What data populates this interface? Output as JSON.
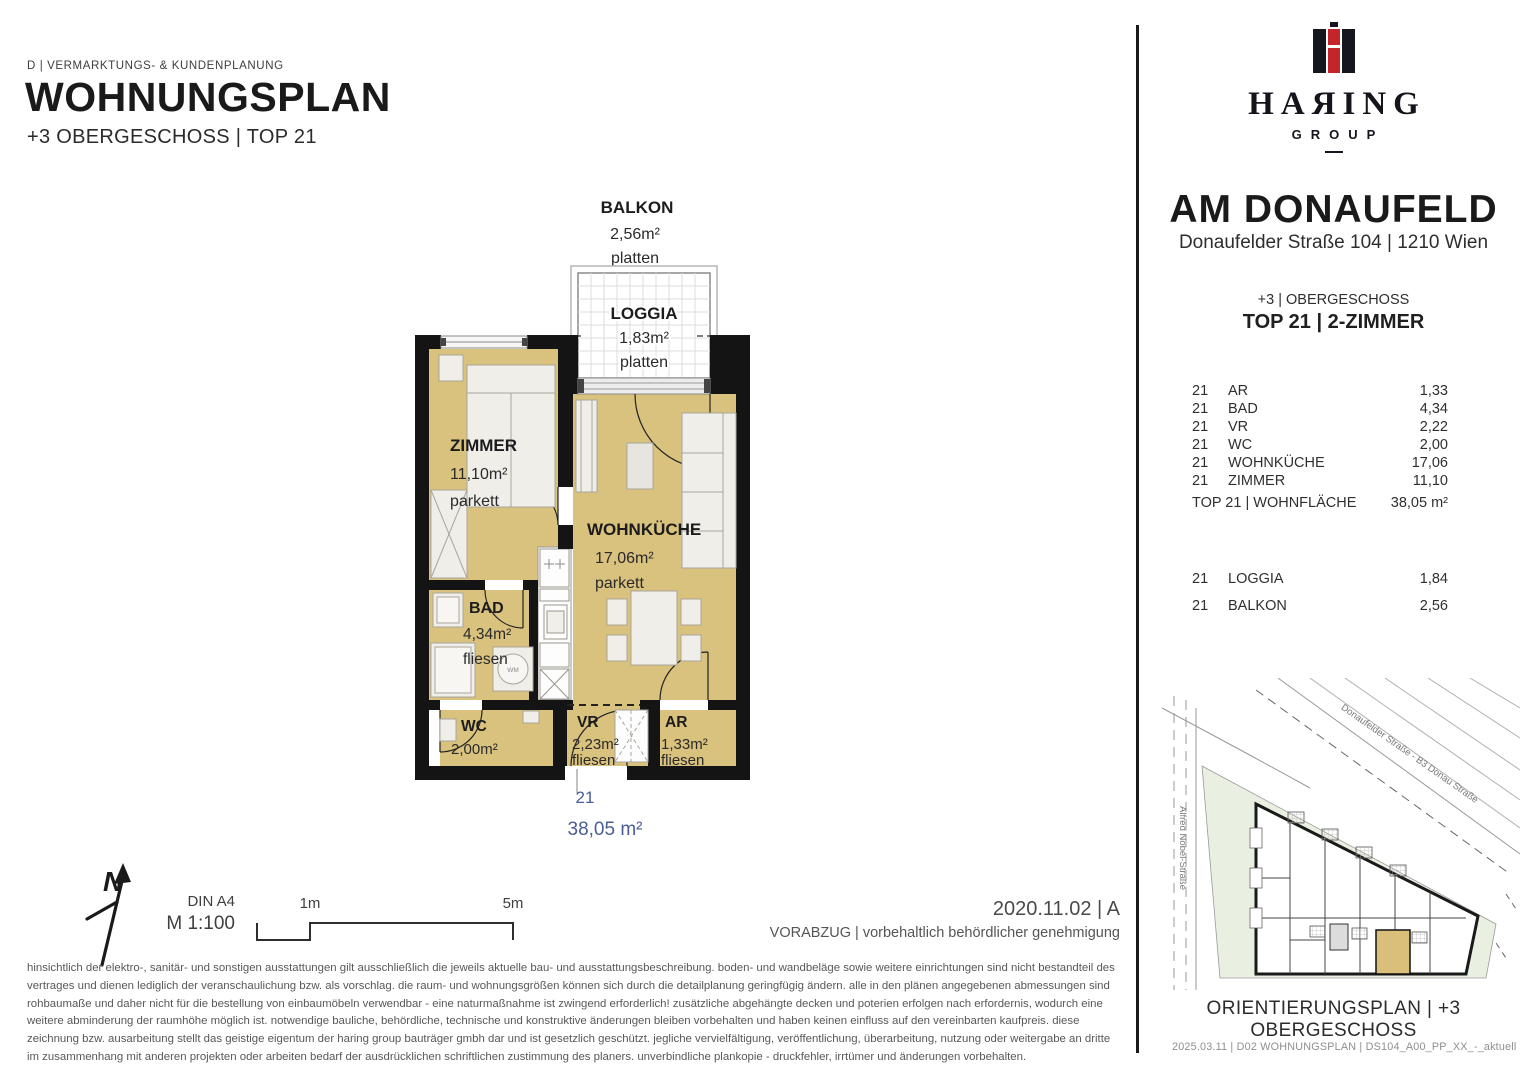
{
  "header": {
    "dept_line": "D | VERMARKTUNGS- & KUNDENPLANUNG",
    "title": "WOHNUNGSPLAN",
    "subtitle": "+3 OBERGESCHOSS | TOP 21"
  },
  "floorplan": {
    "balkon": {
      "name": "BALKON",
      "area": "2,56m²",
      "floor": "platten"
    },
    "loggia": {
      "name": "LOGGIA",
      "area": "1,83m²",
      "floor": "platten"
    },
    "zimmer": {
      "name": "ZIMMER",
      "area": "11,10m²",
      "floor": "parkett"
    },
    "wohnkueche": {
      "name": "WOHNKÜCHE",
      "area": "17,06m²",
      "floor": "parkett"
    },
    "bad": {
      "name": "BAD",
      "area": "4,34m²",
      "floor": "fliesen"
    },
    "wc": {
      "name": "WC",
      "area": "2,00m²"
    },
    "vr": {
      "name": "VR",
      "area": "2,23m²",
      "floor": "fliesen"
    },
    "ar": {
      "name": "AR",
      "area": "1,33m²",
      "floor": "fliesen"
    },
    "wm_label": "WM",
    "unit_number": "21",
    "unit_area": "38,05 m²",
    "accent_blue": "#4a5d94",
    "room_fill": "#d9c17e",
    "wall_color": "#141414"
  },
  "scalebar": {
    "din": "DIN A4",
    "scale": "M 1:100",
    "m1": "1m",
    "m5": "5m",
    "north": "N"
  },
  "version": {
    "date_line": "2020.11.02 | A",
    "status_line": "VORABZUG | vorbehaltlich behördlicher genehmigung"
  },
  "disclaimer": "hinsichtlich der elektro-, sanitär- und sonstigen ausstattungen gilt ausschließlich die jeweils aktuelle bau- und ausstattungsbeschreibung. boden- und wandbeläge sowie weitere einrichtungen sind nicht bestandteil des vertrages und dienen lediglich der veranschaulichung bzw. als vorschlag. die raum- und wohnungsgrößen können sich durch die detailplanung geringfügig ändern. alle in den plänen angegebenen abmessungen sind rohbaumaße und daher nicht für die bestellung von einbaumöbeln verwendbar - eine naturmaßnahme ist zwingend erforderlich! zusätzliche abgehängte decken und poterien erfolgen nach erfordernis, wodurch eine weitere abminderung der raumhöhe möglich ist. notwendige bauliche, behördliche, technische und konstruktive änderungen bleiben vorbehalten und haben keinen einfluss auf den vereinbarten kaufpreis. diese zeichnung bzw. ausarbeitung stellt das geistige eigentum der haring group bauträger gmbh dar und ist gesetzlich geschützt. jegliche vervielfältigung, veröffentlichung, überarbeitung, nutzung oder weitergabe an dritte im zusammenhang mit anderen projekten oder arbeiten bedarf der ausdrücklichen schriftlichen zustimmung des planers. unverbindliche plankopie - druckfehler, irrtümer und änderungen vorbehalten.",
  "brand": {
    "name": "HAЯING",
    "group": "GROUP",
    "red": "#c5242b"
  },
  "project": {
    "title": "AM DONAUFELD",
    "address": "Donaufelder Straße 104 | 1210 Wien",
    "floor_line": "+3 | OBERGESCHOSS",
    "top_line": "TOP 21 | 2-ZIMMER"
  },
  "room_table": {
    "rows": [
      {
        "nr": "21",
        "name": "AR",
        "value": "1,33"
      },
      {
        "nr": "21",
        "name": "BAD",
        "value": "4,34"
      },
      {
        "nr": "21",
        "name": "VR",
        "value": "2,22"
      },
      {
        "nr": "21",
        "name": "WC",
        "value": "2,00"
      },
      {
        "nr": "21",
        "name": "WOHNKÜCHE",
        "value": "17,06"
      },
      {
        "nr": "21",
        "name": "ZIMMER",
        "value": "11,10"
      }
    ],
    "total_label": "TOP 21 | WOHNFLÄCHE",
    "total_value": "38,05 m²",
    "outdoor": [
      {
        "nr": "21",
        "name": "LOGGIA",
        "value": "1,84"
      },
      {
        "nr": "21",
        "name": "BALKON",
        "value": "2,56"
      }
    ]
  },
  "siteplan": {
    "street_main": "Donaufelder Straße - B3 Donau Straße",
    "street_left": "Alfred Nobel-Straße",
    "caption": "ORIENTIERUNGSPLAN | +3 OBERGESCHOSS",
    "footer": "2025.03.11 | D02 WOHNUNGSPLAN | DS104_A00_PP_XX_-_aktuell"
  }
}
